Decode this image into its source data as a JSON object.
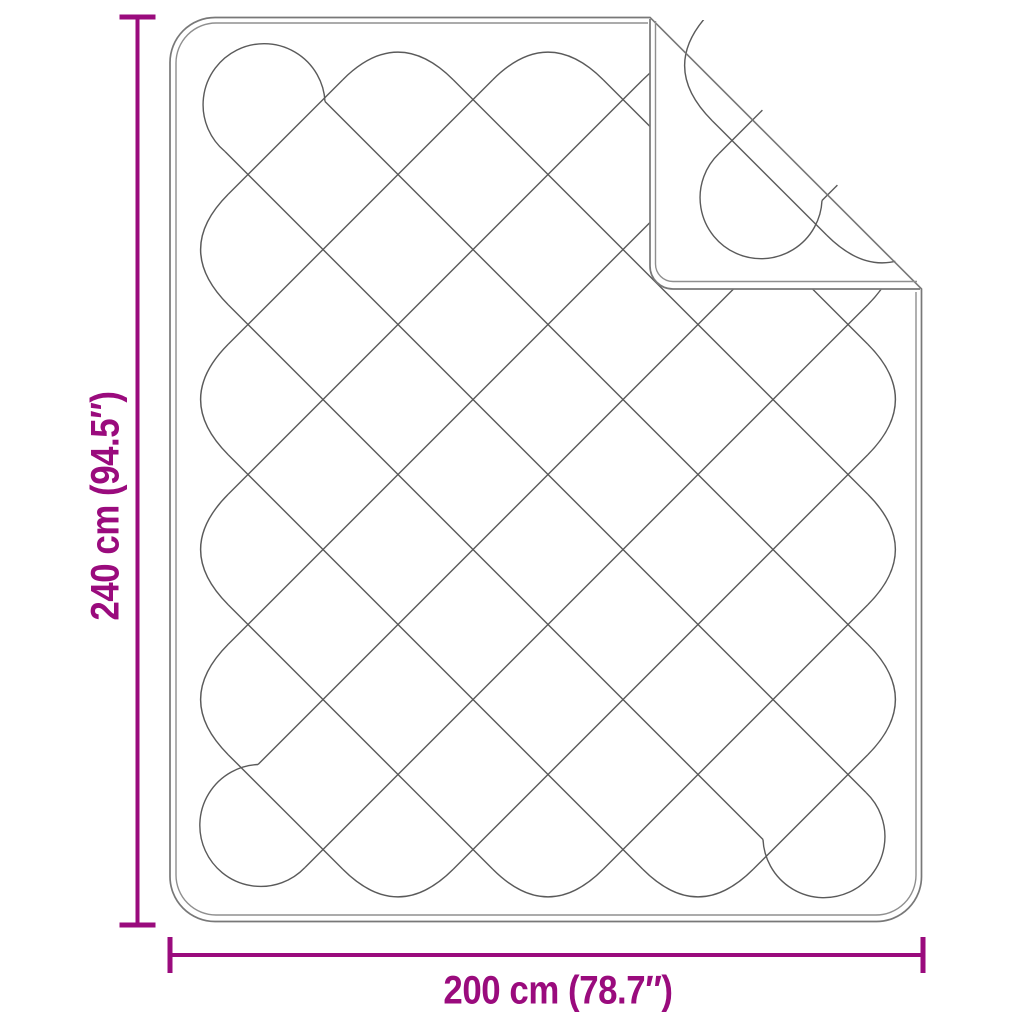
{
  "diagram": {
    "type": "product-dimension-diagram",
    "product": "quilted-blanket-with-folded-corner",
    "height": {
      "label": "240 cm (94.5″)",
      "cm": 240,
      "inches": 94.5
    },
    "width": {
      "label": "200 cm (78.7″)",
      "cm": 200,
      "inches": 78.7
    }
  },
  "colors": {
    "accent": "#9a0b7d",
    "outline": "#787878",
    "inner_line": "#8f8f8f",
    "stitch": "#5a5a5a",
    "background": "#ffffff"
  }
}
